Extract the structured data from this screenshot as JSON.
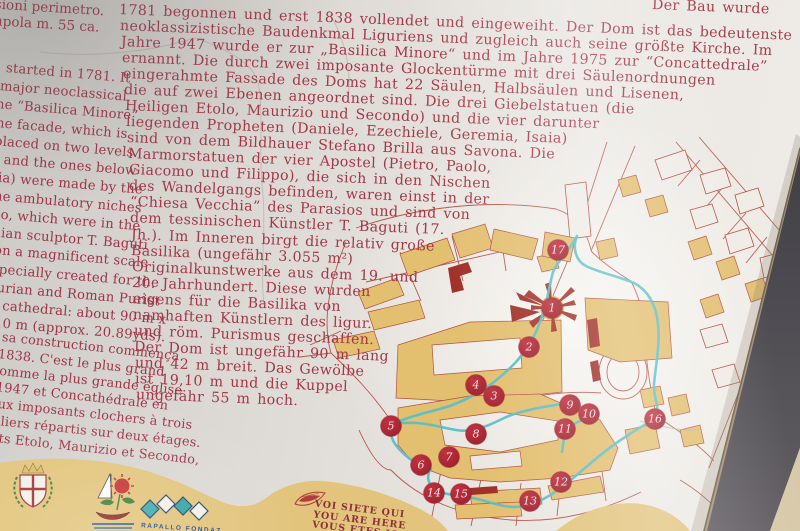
{
  "sign": {
    "italian": {
      "lines": [
        {
          "t": "nsioni perimetro.",
          "x": -14,
          "y": -4
        },
        {
          "t": "a cupola m. 55 ca.",
          "x": -26,
          "y": 12
        }
      ]
    },
    "english": {
      "lines": [
        {
          "t": "started in 1781. It",
          "x": 6,
          "y": 61
        },
        {
          "t": "major neoclassical",
          "x": 0,
          "y": 79
        },
        {
          "t": "ne “Basilica Minore”",
          "x": -4,
          "y": 97
        },
        {
          "t": "ne facade, which is",
          "x": -4,
          "y": 116
        },
        {
          "t": "placed on two levels.",
          "x": -6,
          "y": 134
        },
        {
          "t": ") and the ones below",
          "x": -6,
          "y": 152
        },
        {
          "t": "aia) were made by the",
          "x": -10,
          "y": 170
        },
        {
          "t": "he ambulatory niches",
          "x": -6,
          "y": 189
        },
        {
          "t": "po, which  were in the",
          "x": -8,
          "y": 207
        },
        {
          "t": "inian sculptor T. Baguti",
          "x": -12,
          "y": 225
        },
        {
          "t": "on a magnificent scale",
          "x": -6,
          "y": 243
        },
        {
          "t": "specially created for the",
          "x": -8,
          "y": 262
        },
        {
          "t": "gurian and Roman Purist",
          "x": -12,
          "y": 280
        },
        {
          "t": "e cathedral: about 90 m x",
          "x": -10,
          "y": 298
        },
        {
          "t": "10 m (approx. 20.89yds).",
          "x": -6,
          "y": 316
        }
      ]
    },
    "french": {
      "lines": [
        {
          "t": "sa construction commença",
          "x": 2,
          "y": 330
        },
        {
          "t": "1838. C'est le plus grand",
          "x": -2,
          "y": 347
        },
        {
          "t": "comme la plus grande église",
          "x": -8,
          "y": 363
        },
        {
          "t": "1947 et Concathédrale en",
          "x": -4,
          "y": 380
        },
        {
          "t": "eux imposants clochers à trois",
          "x": -10,
          "y": 396
        },
        {
          "t": "piliers répartis sur deux étages.",
          "x": -12,
          "y": 413
        },
        {
          "t": "ints Etolo, Maurizio et Secondo,",
          "x": -14,
          "y": 430
        }
      ]
    },
    "german": {
      "lines": [
        {
          "t": "Der Bau wurde",
          "x": 652,
          "y": -3
        },
        {
          "t": "1781 begonnen und erst 1838 vollendet und eingeweiht. Der Dom ist das bedeutenste",
          "x": 119,
          "y": 2
        },
        {
          "t": "neoklassizistische Baudenkmal Liguriens und zugleich auch seine größte Kirche. Im",
          "x": 120,
          "y": 18
        },
        {
          "t": "Jahre 1947 wurde er zur „Basilica Minore“ und im Jahre 1975 zur “Concattedrale”",
          "x": 121,
          "y": 34
        },
        {
          "t": "ernannt.  Die durch zwei imposante Glockentürme mit drei Säulenordnungen",
          "x": 122,
          "y": 50
        },
        {
          "t": "eingerahmte Fassade des Doms hat 22 Säulen, Halbsäulen und Lisenen,",
          "x": 123,
          "y": 66
        },
        {
          "t": "die auf zwei Ebenen angeordnet sind. Die drei Giebelstatuen (die",
          "x": 124,
          "y": 82
        },
        {
          "t": "Heiligen Etolo, Maurizio und Secondo) und die vier darunter",
          "x": 125,
          "y": 98
        },
        {
          "t": "liegenden Propheten (Daniele, Ezechiele, Geremia, Isaia)",
          "x": 126,
          "y": 114
        },
        {
          "t": "sind von dem Bildhauer Stefano Brilla aus Savona. Die",
          "x": 127,
          "y": 130
        },
        {
          "t": "Marmorstatuen der vier Apostel (Pietro, Paolo,",
          "x": 128,
          "y": 146
        },
        {
          "t": "Giacomo und Filippo), die sich in den Nischen",
          "x": 129,
          "y": 162
        },
        {
          "t": "des Wandelgangs befinden, waren einst in der",
          "x": 129,
          "y": 178
        },
        {
          "t": "“Chiesa Vecchia” des Parasios und sind von",
          "x": 130,
          "y": 194
        },
        {
          "t": "dem tessinischen Künstler T. Baguti (17.",
          "x": 130,
          "y": 210
        },
        {
          "t": "Jh.). Im Inneren birgt die relativ große",
          "x": 131,
          "y": 227
        },
        {
          "t": "Basilika  (ungefähr  3.055  m²)",
          "x": 131,
          "y": 243
        },
        {
          "t": "Originalkunstwerke aus dem 19. und",
          "x": 132,
          "y": 259
        },
        {
          "t": "20. Jahrhundert.  Diese  wurden",
          "x": 132,
          "y": 275
        },
        {
          "t": "eigens  für  die  Basilika  von",
          "x": 133,
          "y": 291
        },
        {
          "t": "namhaften Künstlern des ligur.",
          "x": 133,
          "y": 307
        },
        {
          "t": "und röm. Purismus geschaffen.",
          "x": 134,
          "y": 323
        },
        {
          "t": "Der Dom ist ungefähr 90 m lang",
          "x": 134,
          "y": 339
        },
        {
          "t": "und 42 m breit. Das Gewölbe",
          "x": 135,
          "y": 355
        },
        {
          "t": "ist 19,10 m und die Kuppel",
          "x": 135,
          "y": 371
        },
        {
          "t": "ungefähr 55 m hoch.",
          "x": 136,
          "y": 387
        }
      ]
    },
    "map": {
      "markers": [
        {
          "n": "17",
          "x": 558,
          "y": 250
        },
        {
          "n": "1",
          "x": 552,
          "y": 308
        },
        {
          "n": "2",
          "x": 529,
          "y": 347
        },
        {
          "n": "4",
          "x": 476,
          "y": 385
        },
        {
          "n": "3",
          "x": 494,
          "y": 396
        },
        {
          "n": "5",
          "x": 391,
          "y": 426
        },
        {
          "n": "6",
          "x": 421,
          "y": 465
        },
        {
          "n": "7",
          "x": 449,
          "y": 457
        },
        {
          "n": "8",
          "x": 476,
          "y": 434
        },
        {
          "n": "9",
          "x": 570,
          "y": 405
        },
        {
          "n": "10",
          "x": 589,
          "y": 414
        },
        {
          "n": "11",
          "x": 565,
          "y": 429
        },
        {
          "n": "12",
          "x": 561,
          "y": 482
        },
        {
          "n": "13",
          "x": 530,
          "y": 501
        },
        {
          "n": "14",
          "x": 434,
          "y": 493
        },
        {
          "n": "15",
          "x": 461,
          "y": 494
        },
        {
          "n": "16",
          "x": 655,
          "y": 419
        }
      ],
      "route_color": "#58bfc8",
      "building_color": "#e3bf70",
      "street_color": "#b44639",
      "marker_color": "#ad2531"
    },
    "footer": {
      "you_are_here_line1": "VOI SIETE QUI",
      "you_are_here_line2": "YOU ARE HERE",
      "you_are_here_line3": "VOUS ETES ICI",
      "diamonds_caption": "RAPALLO  FONDAZ",
      "band_color": "#e2c47c"
    },
    "colors": {
      "text_red": "#a23746",
      "paper": "#e2dfda",
      "edge_dark": "#45434a",
      "ground_sand": "#d6c8a6"
    }
  }
}
